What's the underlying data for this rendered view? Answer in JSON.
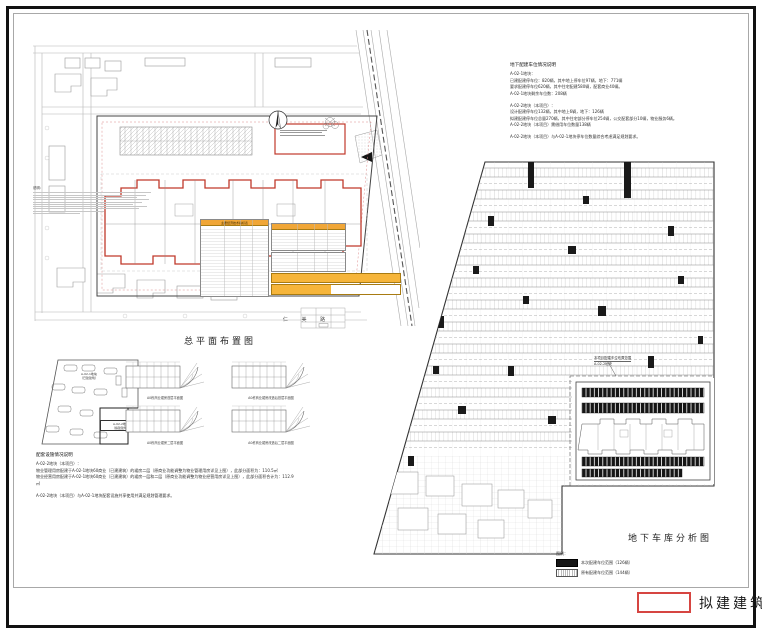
{
  "titles": {
    "site_plan": "总平面布置图",
    "garage": "地下车库分析图"
  },
  "proposed_legend": {
    "label": "拟建建筑"
  },
  "site_plan": {
    "road_label": "仁 美 路",
    "notes_heading": "说明：",
    "table_main_title": "主要经济技术指标表"
  },
  "parking_note": {
    "heading": "地下配建车位情况说明",
    "lines": [
      "A-02-1地块：",
      "已建配建停车位：820辆，其中地上停车位97辆，地下：771辆",
      "要求配建停车位620辆，其中住宅配建580辆，配套商业40辆。",
      "A-02-1地块剩余车位数：208辆",
      "",
      "A-02-2地块（本项目）：",
      "设计配建停车位132辆，其中地上6辆，地下：126辆",
      "拟建配建停车位总量270辆，其中住宅部分停车位254辆，公交配套部分10辆，物业服务6辆。",
      "A-02-2地块（本项目）需借用车位数量138辆",
      "",
      "A-02-2地块（本项目）与A-02-1地块停车位数量综合考虑满足规划要求。"
    ]
  },
  "facility_note": {
    "heading": "配套设施情况说明",
    "lines": [
      "A-02-2地块（本项目）：",
      "物业管理用房配建于A-02-1地块60商业（已建建筑）的裙房二层（原商业功能调整为物业管理用房详见上图），此部分面积为：110.5㎡",
      "物业经营用房配建于A-02-1地块60商业（已建建筑）的裙房一层和二层（原商业功能调整为物业经营用房详见上图），此部分面积合计为：112.9㎡",
      "",
      "A-02-2地块（本项目）与A-02-1地块配套设施共享使用并满足规划管理要求。"
    ]
  },
  "keyplan": {
    "parcel_a": "A-02-1地块",
    "parcel_a_sub": "（已建建筑）",
    "parcel_b": "A-02-2地块",
    "parcel_b_sub": "（拟建建筑）"
  },
  "floor_plans": {
    "captions": [
      "A0栋商业裙房首层平面图",
      "A0栋商业裙房改造后首层平面图",
      "A0栋商业裙房二层平面图",
      "A0栋商业裙房改造后二层平面图"
    ]
  },
  "garage": {
    "inset_label_line1": "本项目配建车位布置范围",
    "inset_label_line2": "A-02-2地块",
    "legend_heading": "图例：",
    "legend_items": [
      {
        "label": "本次配建车位范围（126辆）",
        "swatch": "solid"
      },
      {
        "label": "原有配建车位范围（144辆）",
        "swatch": "hatch"
      }
    ]
  },
  "colors": {
    "accent_red": "#c0392b",
    "legend_red": "#d64541",
    "table_header_orange": "#f0a637",
    "line_dark": "#333333",
    "line_gray": "#999999"
  }
}
